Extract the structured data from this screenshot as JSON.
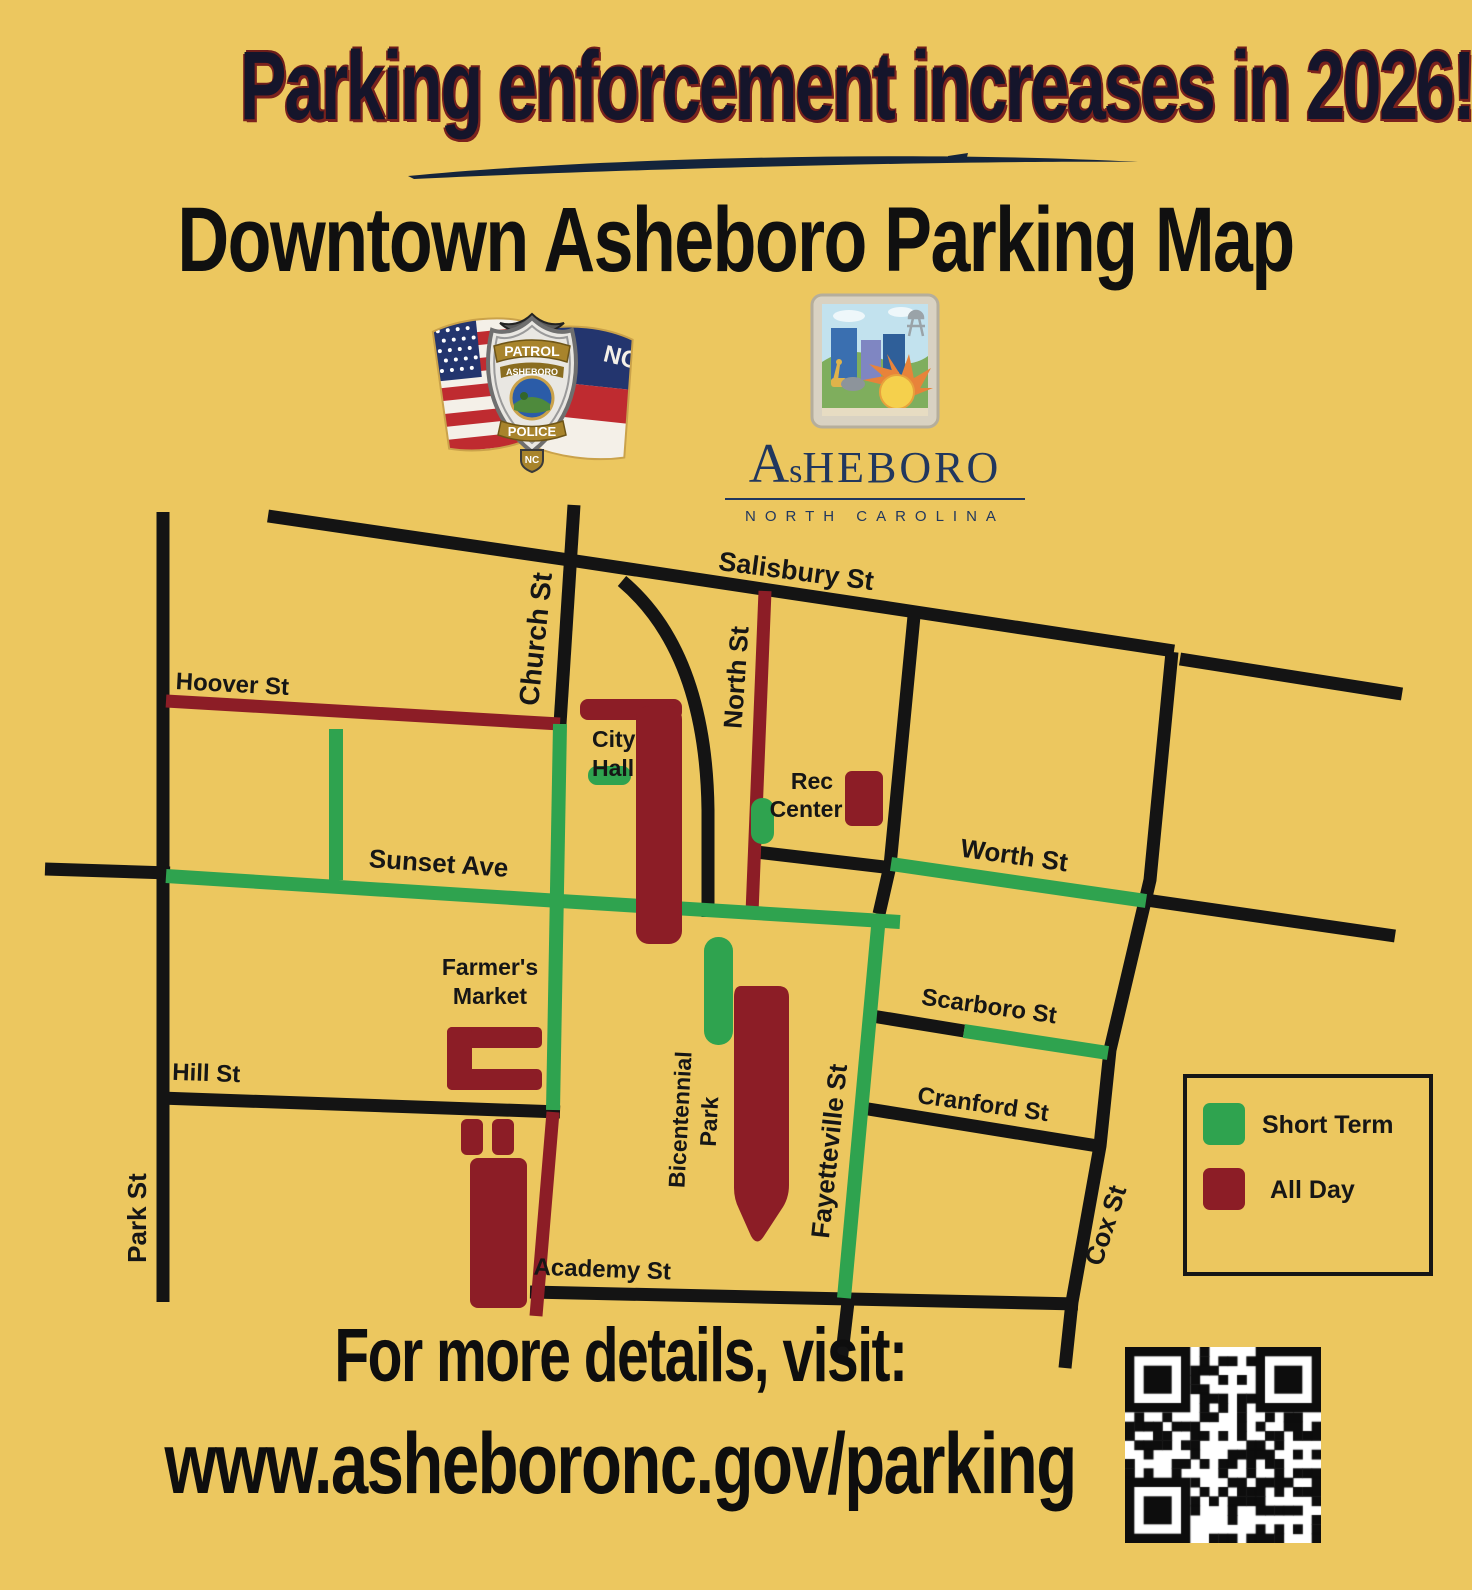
{
  "title": "Parking enforcement increases in 2026!",
  "subtitle": "Downtown Asheboro Parking Map",
  "police_badge": {
    "patrol": "PATROL",
    "asheboro": "ASHEBORO",
    "police": "POLICE",
    "nc_tab": "NC",
    "flag_nc": "NC"
  },
  "city_logo": {
    "wordmark_a": "A",
    "wordmark_s": "s",
    "wordmark_rest": "HEBORO",
    "tagline": "NORTH CAROLINA"
  },
  "map": {
    "colors": {
      "background": "#ecc75f",
      "road": "#141414",
      "short_term": "#2fa34f",
      "all_day": "#8c1d26"
    },
    "streets": {
      "salisbury": "Salisbury St",
      "church": "Church St",
      "north": "North St",
      "hoover": "Hoover St",
      "sunset": "Sunset Ave",
      "worth": "Worth St",
      "scarboro": "Scarboro St",
      "cranford": "Cranford St",
      "hill": "Hill St",
      "park": "Park St",
      "fayetteville": "Fayetteville St",
      "cox": "Cox St",
      "academy": "Academy St"
    },
    "landmarks": {
      "city_hall_line1": "City",
      "city_hall_line2": "Hall",
      "rec_center_line1": "Rec",
      "rec_center_line2": "Center",
      "farmers_market_line1": "Farmer's",
      "farmers_market_line2": "Market",
      "bicentennial_line1": "Bicentennial",
      "bicentennial_line2": "Park"
    }
  },
  "legend": {
    "items": [
      {
        "label": "Short Term",
        "color": "#2fa34f"
      },
      {
        "label": "All Day",
        "color": "#8c1d26"
      }
    ]
  },
  "footer": {
    "line1": "For more details, visit:",
    "line2": "www.asheboronc.gov/parking"
  }
}
